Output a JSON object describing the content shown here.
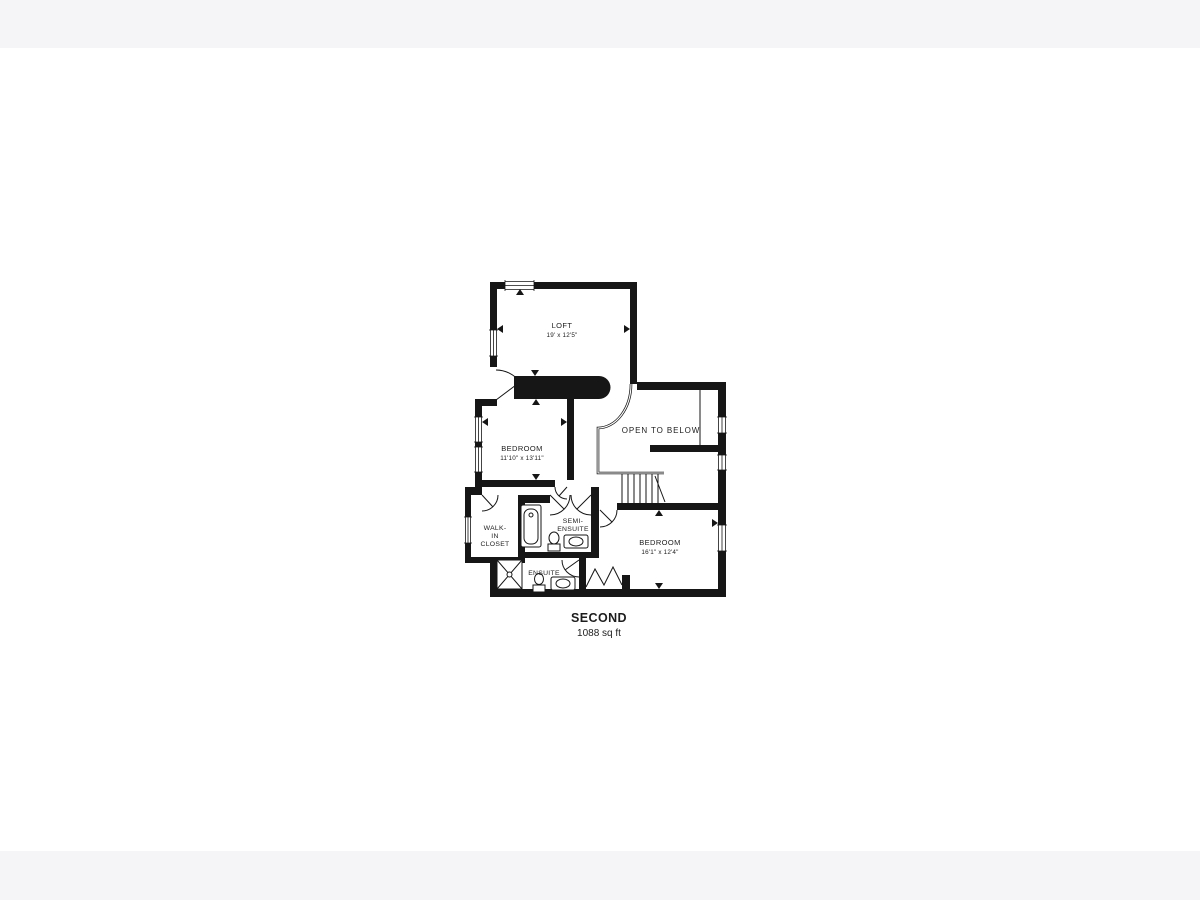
{
  "page": {
    "background_band_color": "#f5f5f8",
    "canvas_color": "#ffffff",
    "wall_color": "#161616"
  },
  "plan": {
    "title": "SECOND",
    "area": "1088 sq ft",
    "rooms": {
      "loft": {
        "name": "LOFT",
        "dims": "19' x 12'5\""
      },
      "bedroom1": {
        "name": "BEDROOM",
        "dims": "11'10\" x 13'11\""
      },
      "bedroom2": {
        "name": "BEDROOM",
        "dims": "16'1\" x 12'4\""
      },
      "open_to_below": {
        "name": "OPEN TO BELOW"
      },
      "walk_in_closet": {
        "line1": "WALK-",
        "line2": "IN",
        "line3": "CLOSET"
      },
      "semi_ensuite": {
        "line1": "SEMI-",
        "line2": "ENSUITE"
      },
      "ensuite": {
        "name": "ENSUITE"
      }
    }
  }
}
